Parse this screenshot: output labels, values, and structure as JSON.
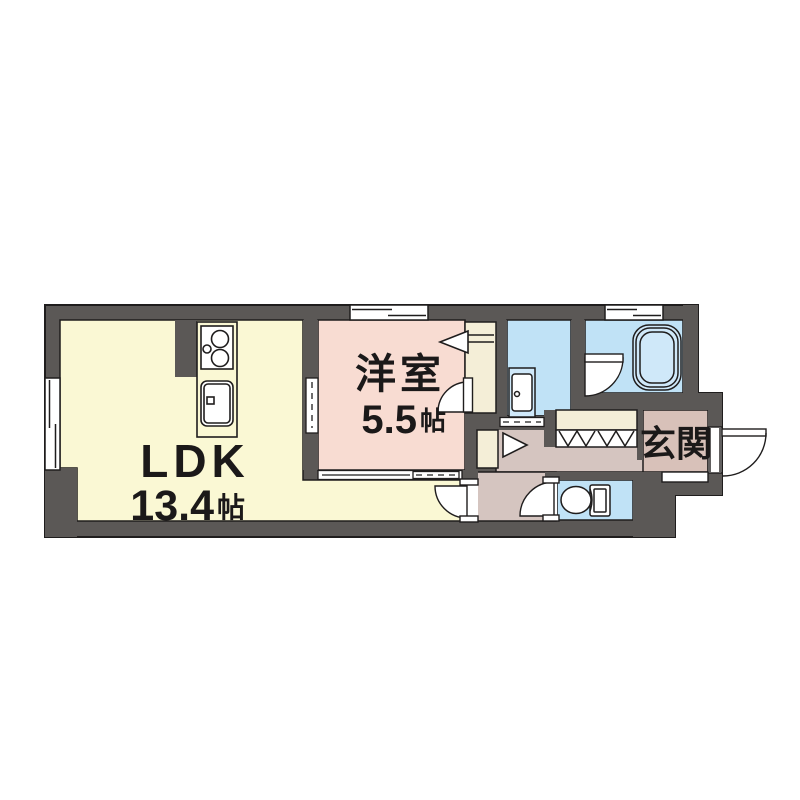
{
  "plan": {
    "type": "apartment-floorplan",
    "rooms": {
      "ldk": {
        "label": "LDK",
        "area_value": "13.4",
        "area_unit": "帖"
      },
      "yoshitsu": {
        "label": "洋室",
        "area_value": "5.5",
        "area_unit": "帖"
      },
      "genkan": {
        "label": "玄関"
      }
    },
    "fixtures": [
      "kitchen-stove",
      "kitchen-sink",
      "washbasin",
      "bathtub",
      "toilet",
      "entrance-door",
      "room-doors",
      "sliding-doors",
      "windows",
      "closets"
    ],
    "colors": {
      "wall": "#5b5856",
      "ldk": "#faf8d4",
      "pink": "#f8dcd2",
      "blue": "#c0e2f6",
      "blue_soft": "#cfe8f9",
      "hall": "#d5c5c0",
      "genkan": "#d8c1b9",
      "closet": "#f4eed7",
      "line": "#1f1d1d",
      "white": "#ffffff"
    }
  }
}
